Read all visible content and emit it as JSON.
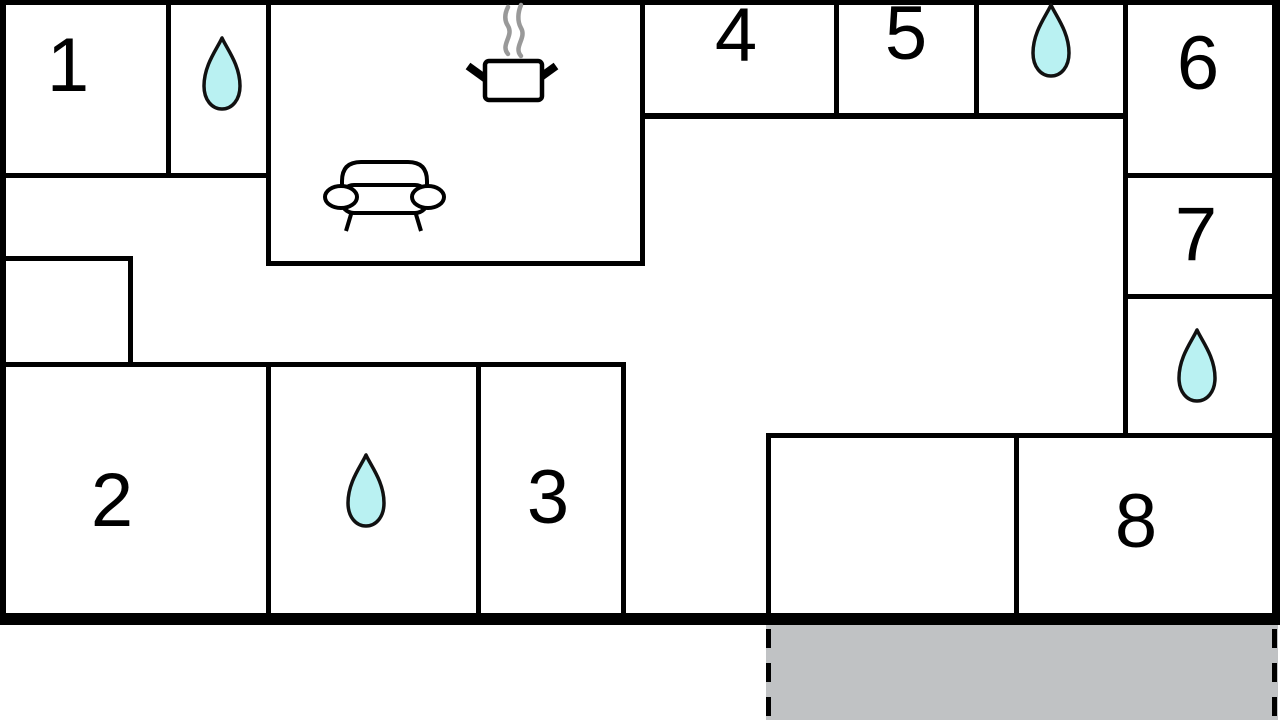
{
  "floor_plan": {
    "colors": {
      "background": "#ffffff",
      "wall": "#000000",
      "label-color": "#000000",
      "drop-fill": "#b9f1f2",
      "drop-outline": "#111111",
      "steam": "#999999",
      "terrace-fill": "#c0c2c4"
    },
    "rooms": [
      {
        "label": "1"
      },
      {
        "label": "2"
      },
      {
        "label": "3"
      },
      {
        "label": "4"
      },
      {
        "label": "5"
      },
      {
        "label": "6"
      },
      {
        "label": "7"
      },
      {
        "label": "8"
      }
    ],
    "icons": [
      {
        "name": "water-drop-icon",
        "count": 4,
        "meaning": "water point"
      },
      {
        "name": "cooking-pot-icon",
        "count": 1,
        "meaning": "kitchen"
      },
      {
        "name": "sofa-icon",
        "count": 1,
        "meaning": "living area"
      }
    ]
  }
}
